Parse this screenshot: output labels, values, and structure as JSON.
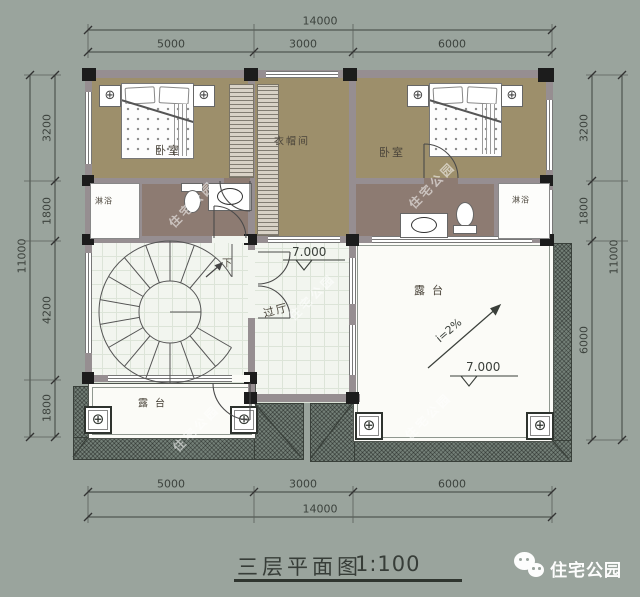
{
  "title": {
    "name": "三层平面图",
    "scale": "1:100"
  },
  "logo": {
    "text": "住宅公园"
  },
  "watermark": {
    "text": "住宅公园"
  },
  "icons": {
    "ceiling_lamp": "⊕",
    "column": "⊕",
    "level_triangle": "▽"
  },
  "rooms": {
    "bedroom_left": "卧室",
    "closet": "衣帽间",
    "bedroom_right": "卧室",
    "shower_left": "淋浴",
    "shower_right": "淋浴",
    "hall": "过厅",
    "stairs_down": "下",
    "terrace_right": "露台",
    "terrace_bottom_left": "露台"
  },
  "markers": {
    "hall_level": "7.000",
    "terrace_level": "7.000",
    "terrace_slope": "i=2%"
  },
  "dimensions": {
    "top": {
      "overall": "14000",
      "segments": [
        "5000",
        "3000",
        "6000"
      ]
    },
    "bottom": {
      "overall": "14000",
      "segments": [
        "5000",
        "3000",
        "6000"
      ]
    },
    "left": {
      "overall": "11000",
      "segments": [
        "3200",
        "1800",
        "4200",
        "1800"
      ]
    },
    "right": {
      "overall": "11000",
      "segments": [
        "3200",
        "1800",
        "6000"
      ]
    }
  },
  "colors": {
    "background": "#9aa49d",
    "bedroom_floor": "#9d8f6b",
    "bath_floor": "#8d7b72",
    "tile_floor": "#f2f5ef",
    "terrace_floor": "#fbfbf7",
    "wall": "#968e91",
    "wall_dark": "#1c1c1c",
    "roof_hatch": "#737f77",
    "dim_text": "#3c423d"
  }
}
